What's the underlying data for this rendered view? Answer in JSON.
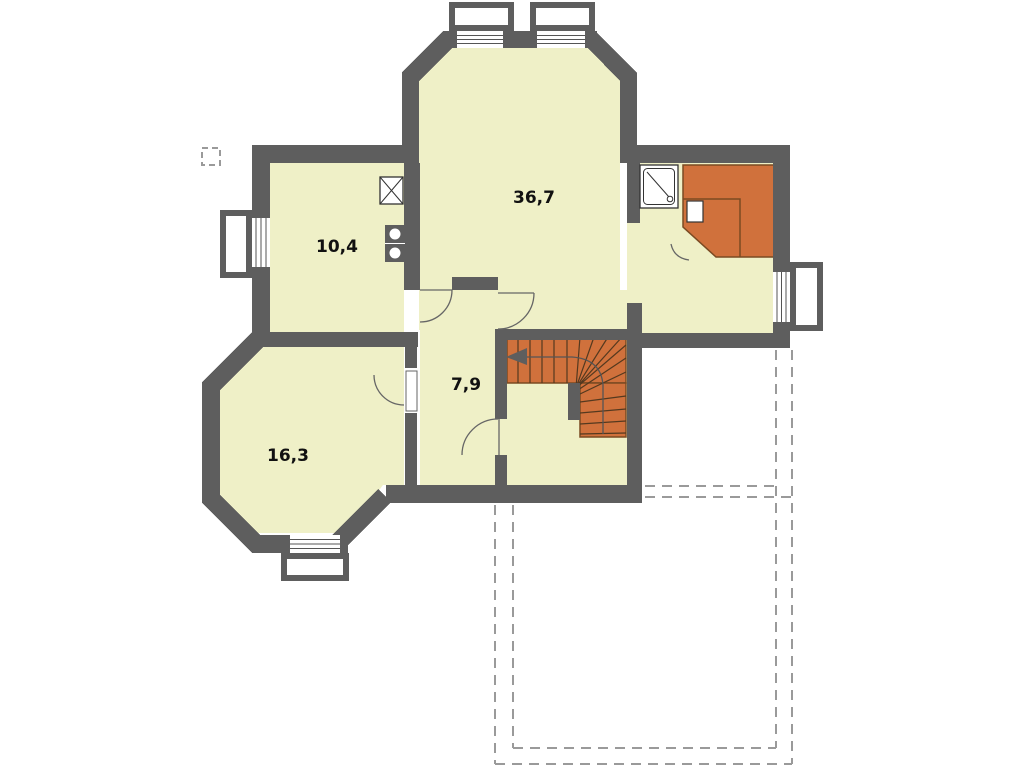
{
  "type": "floor-plan",
  "rooms": [
    {
      "name": "large-room",
      "area_label": "36,7"
    },
    {
      "name": "kitchen",
      "area_label": "10,4"
    },
    {
      "name": "room-bottom-left",
      "area_label": "16,3"
    },
    {
      "name": "hallway",
      "area_label": "7,9"
    }
  ],
  "colors": {
    "wall": "#5E5E5E",
    "floor": "#EFF0C7",
    "stairs_sauna": "#D0713C",
    "stairs_outline": "#7A4A22",
    "tread_line": "#54391F",
    "door_arc": "#666666",
    "fixture_line": "#333333",
    "dashed_line": "#9A9A9A",
    "glazing_line": "#555555",
    "label": "#111111"
  },
  "features": [
    "winder-staircase",
    "stair-direction-arrow",
    "sauna-with-benches",
    "sauna-heater",
    "shower-tray",
    "kitchen-sink",
    "stove-two-burners",
    "window",
    "door-swing-arc",
    "terrace-dashed-outline",
    "chimney-dashed-outline"
  ]
}
